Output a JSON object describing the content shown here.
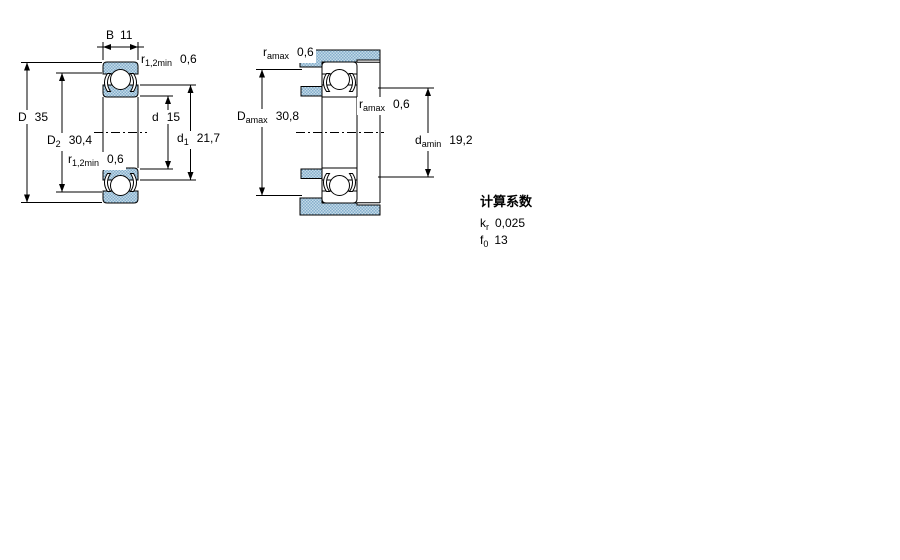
{
  "drawing": {
    "left_view": {
      "labels": {
        "width": {
          "sym": "B",
          "val": "11"
        },
        "chamfer_top": {
          "sym": "r",
          "sub": "1,2min",
          "val": "0,6"
        },
        "outer_diameter": {
          "sym": "D",
          "val": "35"
        },
        "shield_diameter": {
          "sym": "D",
          "sub": "2",
          "val": "30,4"
        },
        "bore_diameter": {
          "sym": "d",
          "val": "15"
        },
        "shoulder_diameter": {
          "sym": "d",
          "sub": "1",
          "val": "21,7"
        },
        "chamfer_mid": {
          "sym": "r",
          "sub": "1,2min",
          "val": "0,6"
        }
      }
    },
    "right_view": {
      "labels": {
        "fillet_top": {
          "sym": "r",
          "sub": "amax",
          "val": "0,6"
        },
        "housing_abutment": {
          "sym": "D",
          "sub": "amax",
          "val": "30,8"
        },
        "fillet_mid": {
          "sym": "r",
          "sub": "amax",
          "val": "0,6"
        },
        "shaft_abutment": {
          "sym": "d",
          "sub": "amin",
          "val": "19,2"
        }
      }
    },
    "calculation_factors": {
      "title": "计算系数",
      "rows": [
        {
          "sym": "k",
          "sub": "r",
          "val": "0,025"
        },
        {
          "sym": "f",
          "sub": "0",
          "val": "13"
        }
      ]
    },
    "colors": {
      "shading_light": "#c4dbe8",
      "shading_dark": "#85aecb",
      "line": "#000000"
    }
  }
}
